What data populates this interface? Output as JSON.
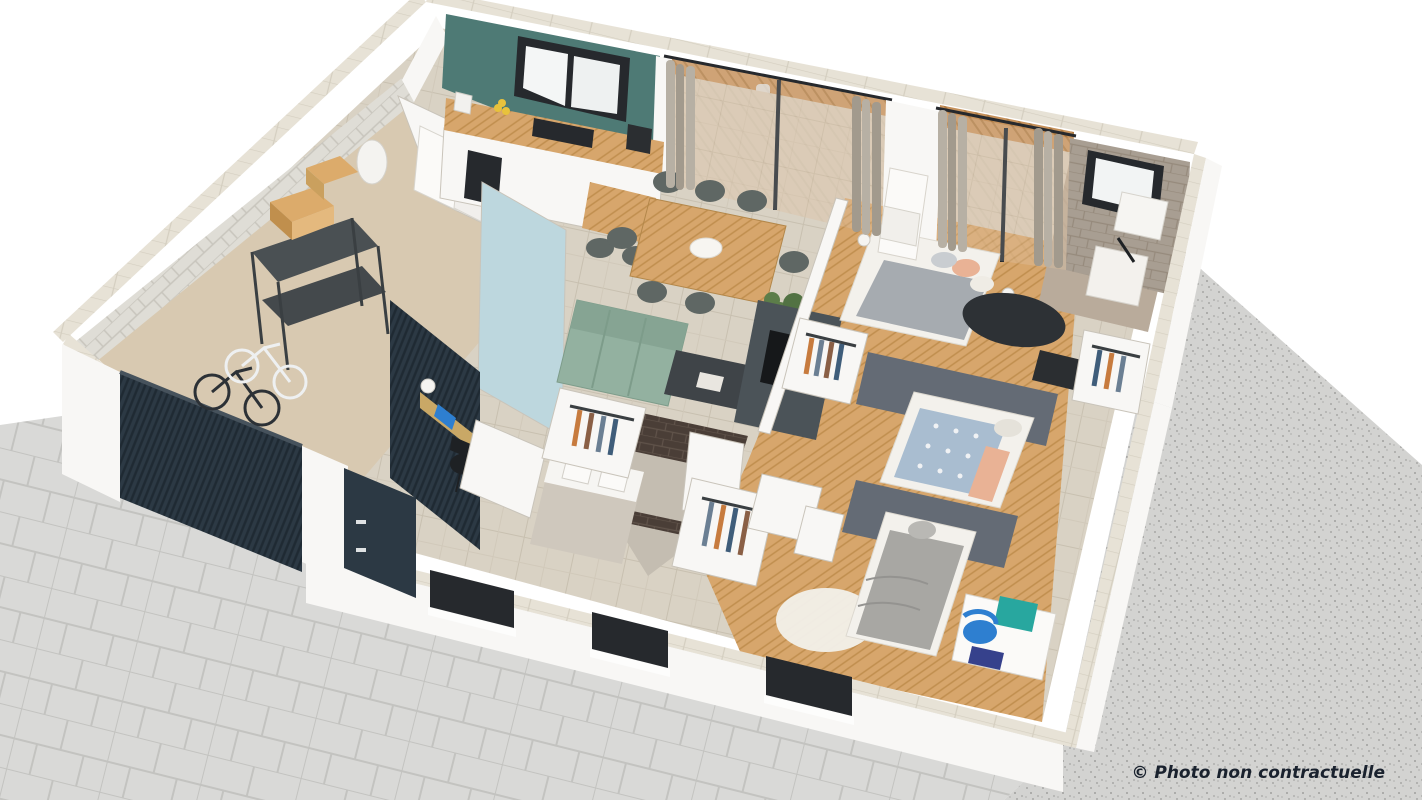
{
  "watermark": {
    "text": "© Photo non contractuelle"
  },
  "colors": {
    "bg": "#ffffff",
    "paver": "#d9d9d7",
    "paver_line": "#c3c3c0",
    "gravel": "#d3d3d1",
    "gravel_dot": "#a8a8a6",
    "wall_white": "#f8f7f5",
    "wall_shadow": "#e9e7e1",
    "wall_top": "#e7e2d6",
    "wall_top_line": "#d4cec0",
    "stone": "#dfddd6",
    "stone_line": "#c8c5bd",
    "teal": "#4e7a75",
    "blue_wall": "#bdd7de",
    "slat": "#2c3944",
    "slat_line": "#1f2a33",
    "door": "#2c3944",
    "frame": "#26292d",
    "glass": "#eef1f2",
    "tile": "#d9d2c4",
    "tile_line": "#c8c0b0",
    "wood": "#d7a66c",
    "wood_line": "#c08e4e",
    "deck": "#c6925c",
    "deck_line": "#b07c44",
    "garage_floor": "#d8c9b1",
    "bath_floor": "#c4bdb1",
    "taupe": "#a89e92",
    "taupe_line": "#968a7c",
    "dbrick": "#4a3e37",
    "dbrick_line": "#60534a",
    "sofa": "#93b1a0",
    "sofa_line": "#7d9c8a",
    "table": "#cb9f5e",
    "table_line": "#b3874a",
    "chair": "#5f6764",
    "coffee_table": "#3f4448",
    "tv_unit": "#4b5358",
    "tv_screen": "#16181a",
    "bed_white": "#f3f1ec",
    "blanket": "#a6abb0",
    "peach": "#e9b295",
    "duvet_blue": "#a9bdd0",
    "duvet_gray": "#a8a7a3",
    "pillow": "#e5e2da",
    "rug_dark": "#2d3135",
    "rug_white": "#f2f0ea",
    "plant": "#5c7d49",
    "pot": "#2e3234",
    "curtain": "#b7b0a4",
    "curtain_dark": "#a29a8d",
    "cardboard": "#dcab6b",
    "shelf": "#3a3f42",
    "bike_dark": "#2c3136",
    "bike_white": "#eef0f1",
    "blue_chair": "#2e7fd0",
    "teal_board": "#28a79f",
    "notebook": "#36418c",
    "marble": "#cfc8bd",
    "sink": "#f6f5f2",
    "gray_wall": "#646b75",
    "clothes1": "#c77b3e",
    "clothes2": "#6b7f93",
    "clothes3": "#8a5f45",
    "clothes4": "#3f5d7a",
    "watermark": "#1a222e"
  },
  "scene": {
    "type": "isometric 3D cutaway floor plan render of a single-storey house",
    "exterior_features": [
      "paved stone driveway",
      "gravel terrace surround",
      "dark sectional garage door",
      "dark front door",
      "white stone perimeter walls",
      "wooden terrace deck with outdoor dining set"
    ],
    "rooms": [
      {
        "name": "garage",
        "features": [
          "light stone wall",
          "black metal shelving",
          "cardboard boxes",
          "two bicycles",
          "water heater",
          "concrete floor"
        ]
      },
      {
        "name": "storage-laundry",
        "features": [
          "white appliances"
        ]
      },
      {
        "name": "kitchen",
        "features": [
          "teal accent wall",
          "black framed window",
          "wooden worktop",
          "black cooktop",
          "oven",
          "coffee machine",
          "fruit bowl",
          "small wooden table with two grey chairs",
          "pale blue partition wall"
        ]
      },
      {
        "name": "living-dining",
        "features": [
          "wooden dining table",
          "six grey chairs",
          "white plate",
          "sage green tufted sofa",
          "dark coffee table",
          "potted plant",
          "tv sideboard",
          "travertine tile floor",
          "sliding bay doors with grey curtains"
        ]
      },
      {
        "name": "entry",
        "features": [
          "dark slatted accent wall",
          "wall-mounted desk",
          "laptop",
          "white lamp",
          "black chair"
        ]
      },
      {
        "name": "master-bedroom",
        "features": [
          "double bed with grey throw and peach pillows",
          "bedside lamps",
          "dark round rug",
          "dressing with hanging clothes",
          "radiator",
          "glazed door to terrace",
          "wooden floor"
        ]
      },
      {
        "name": "ensuite-bathroom",
        "features": [
          "taupe brick walls",
          "black framed window",
          "shower tray",
          "vanity unit"
        ]
      },
      {
        "name": "family-bathroom",
        "features": [
          "dark brick shower walls",
          "double sink vanity",
          "grey floor"
        ]
      },
      {
        "name": "bedroom-2",
        "features": [
          "single bed with blue patterned duvet and peach throw",
          "grey accent wall",
          "wardrobe with hanging clothes",
          "black desk",
          "wooden floor"
        ]
      },
      {
        "name": "bedroom-3",
        "features": [
          "single bed with grey duvet",
          "white desk",
          "blue chair",
          "teal pegboard",
          "white semicircle rug",
          "grey accent wall",
          "window recess",
          "wooden floor"
        ]
      },
      {
        "name": "hallway",
        "features": [
          "wooden floor",
          "dressing closets with hanging clothes"
        ]
      }
    ]
  }
}
